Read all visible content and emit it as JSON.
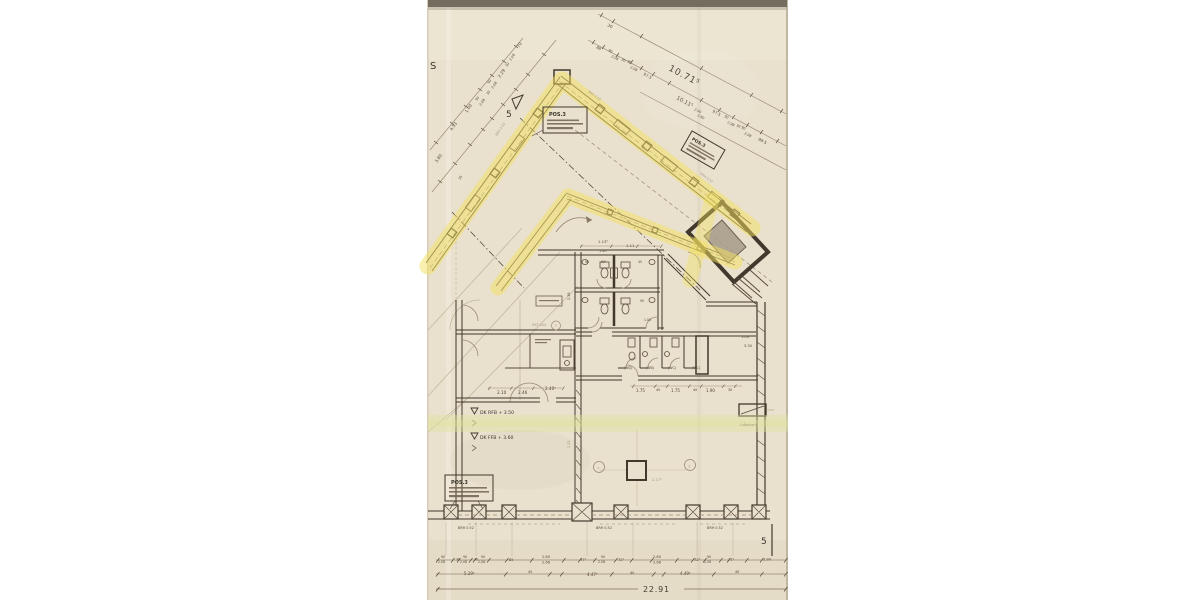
{
  "meta": {
    "description": "Scanned architectural ground-floor plan with yellow highlighter over exterior walls",
    "sheet_type": "floor-plan-scan"
  },
  "palette": {
    "paper": "#e9e1ce",
    "ink": "#5a4c3e",
    "ink_dark": "#42382c",
    "ink_light": "#9a8a72",
    "pencil": "#b9ad95",
    "highlight_yellow": "#f3e25e",
    "highlight_green": "#dfe39b",
    "scan_bar": "#746c5f",
    "vestibule_gray": "#a79b88"
  },
  "landmarks": {
    "sheet_letter": "S",
    "section_marker_top": "5",
    "section_marker_bottom": "5",
    "overall_top": "10.71⁵",
    "overall_top_inner": "10.11⁵",
    "total_width_bottom": "22.91"
  },
  "pos_boxes": [
    {
      "title": "POS.3"
    },
    {
      "title": "POS.3"
    },
    {
      "title": "POS.3"
    }
  ],
  "annotations": [
    {
      "t": "3.80",
      "x": 437,
      "y": 163,
      "r": -56,
      "s": 4.2
    },
    {
      "t": "4.53",
      "x": 452,
      "y": 131,
      "r": -56,
      "s": 4.2
    },
    {
      "t": "1.00",
      "x": 467,
      "y": 113,
      "r": -56,
      "s": 4.2
    },
    {
      "t": "90",
      "x": 477,
      "y": 101,
      "r": -56,
      "s": 3.4
    },
    {
      "t": "2.08",
      "x": 481,
      "y": 106,
      "r": -56,
      "s": 3.4
    },
    {
      "t": "30",
      "x": 488,
      "y": 95,
      "r": -56,
      "s": 3.4
    },
    {
      "t": "90",
      "x": 489,
      "y": 84,
      "r": -56,
      "s": 3.4
    },
    {
      "t": "2.08",
      "x": 493,
      "y": 89,
      "r": -56,
      "s": 3.4
    },
    {
      "t": "2.29",
      "x": 500,
      "y": 78,
      "r": -56,
      "s": 4.2
    },
    {
      "t": "30",
      "x": 507,
      "y": 67,
      "r": -56,
      "s": 3.4
    },
    {
      "t": "2.08",
      "x": 511,
      "y": 61,
      "r": -56,
      "s": 3.4
    },
    {
      "t": "70",
      "x": 519,
      "y": 48,
      "r": -56,
      "s": 4.2
    },
    {
      "t": "35",
      "x": 460,
      "y": 180,
      "r": -56,
      "s": 3.4
    },
    {
      "t": "BRH 2.52",
      "x": 497,
      "y": 136,
      "r": -56,
      "s": 3.2,
      "c": "faint"
    },
    {
      "t": "BRH 2.52",
      "x": 588,
      "y": 92,
      "r": 37,
      "s": 3.2,
      "c": "faint"
    },
    {
      "t": "BRH 2.52",
      "x": 700,
      "y": 174,
      "r": 37,
      "s": 3.2,
      "c": "faint"
    },
    {
      "t": "30",
      "x": 607,
      "y": 26,
      "r": 28,
      "s": 4.2
    },
    {
      "t": "88",
      "x": 596,
      "y": 48,
      "r": 28,
      "s": 3.8
    },
    {
      "t": "90",
      "x": 608,
      "y": 51,
      "r": 28,
      "s": 3.4
    },
    {
      "t": "2.08",
      "x": 611,
      "y": 57,
      "r": 28,
      "s": 3.4
    },
    {
      "t": "30",
      "x": 621,
      "y": 60,
      "r": 28,
      "s": 3.4
    },
    {
      "t": "90",
      "x": 627,
      "y": 62,
      "r": 28,
      "s": 3.4
    },
    {
      "t": "2.08",
      "x": 630,
      "y": 68,
      "r": 28,
      "s": 3.4
    },
    {
      "t": "97.5",
      "x": 643,
      "y": 75,
      "r": 28,
      "s": 4
    },
    {
      "t": "10.11⁵",
      "x": 676,
      "y": 99,
      "r": 28,
      "s": 5.5
    },
    {
      "t": "2.90",
      "x": 694,
      "y": 110,
      "r": 28,
      "s": 3.4
    },
    {
      "t": "3.80",
      "x": 697,
      "y": 116,
      "r": 28,
      "s": 3.4
    },
    {
      "t": "97.5",
      "x": 712,
      "y": 112,
      "r": 28,
      "s": 4
    },
    {
      "t": "90",
      "x": 724,
      "y": 117,
      "r": 28,
      "s": 3.4
    },
    {
      "t": "2.08",
      "x": 727,
      "y": 123,
      "r": 28,
      "s": 3.4
    },
    {
      "t": "30",
      "x": 736,
      "y": 126,
      "r": 28,
      "s": 3.4
    },
    {
      "t": "90",
      "x": 741,
      "y": 128,
      "r": 28,
      "s": 3.4
    },
    {
      "t": "2.08",
      "x": 744,
      "y": 134,
      "r": 28,
      "s": 3.4
    },
    {
      "t": "88.5",
      "x": 758,
      "y": 140,
      "r": 28,
      "s": 4
    },
    {
      "t": "1.13⁵",
      "x": 598,
      "y": 243,
      "s": 3.8
    },
    {
      "t": "1.11",
      "x": 626,
      "y": 247,
      "s": 3.8
    },
    {
      "t": "1.40",
      "x": 599,
      "y": 252,
      "s": 3.4
    },
    {
      "t": "90",
      "x": 585,
      "y": 263,
      "s": 3.2
    },
    {
      "t": "62⁵",
      "x": 601,
      "y": 263,
      "s": 3.2
    },
    {
      "t": "45",
      "x": 638,
      "y": 263,
      "s": 3.2
    },
    {
      "t": "90",
      "x": 640,
      "y": 302,
      "s": 3.2
    },
    {
      "t": "2.38",
      "x": 570,
      "y": 300,
      "r": -90,
      "s": 3.4
    },
    {
      "t": "1.00",
      "x": 644,
      "y": 321,
      "s": 3.2
    },
    {
      "t": "2.10",
      "x": 497,
      "y": 394,
      "s": 4.2
    },
    {
      "t": "2.46",
      "x": 518,
      "y": 394,
      "s": 4.2
    },
    {
      "t": "2.40⁵",
      "x": 545,
      "y": 390,
      "s": 4.2
    },
    {
      "t": "HST 204",
      "x": 532,
      "y": 326,
      "s": 3.3,
      "c": "faint"
    },
    {
      "t": "7",
      "x": 554.5,
      "y": 327,
      "s": 3.6,
      "c": "faint",
      "n": "circled-number"
    },
    {
      "t": "DK RFB + 3.50",
      "x": 480,
      "y": 414,
      "s": 4.6,
      "c": "dark",
      "n": "level-label"
    },
    {
      "t": "DK FFB + 3.60",
      "x": 480,
      "y": 439,
      "s": 4.6,
      "c": "dark",
      "n": "level-label"
    },
    {
      "t": "(WD)",
      "x": 624,
      "y": 369,
      "s": 3.3
    },
    {
      "t": "(WB)",
      "x": 646,
      "y": 369,
      "s": 3.3
    },
    {
      "t": "(WC)",
      "x": 668,
      "y": 369,
      "s": 3.3
    },
    {
      "t": "(WC)",
      "x": 692,
      "y": 369,
      "s": 3.3
    },
    {
      "t": "1.75",
      "x": 636,
      "y": 392,
      "s": 4
    },
    {
      "t": "40",
      "x": 656,
      "y": 391,
      "s": 3.4
    },
    {
      "t": "1.75",
      "x": 671,
      "y": 392,
      "s": 4
    },
    {
      "t": "40",
      "x": 693,
      "y": 391,
      "s": 3.4
    },
    {
      "t": "1.90",
      "x": 706,
      "y": 392,
      "s": 4
    },
    {
      "t": "30",
      "x": 728,
      "y": 391,
      "s": 3.4
    },
    {
      "t": "1.04",
      "x": 741,
      "y": 338,
      "s": 3.6
    },
    {
      "t": "3.30",
      "x": 744,
      "y": 347,
      "s": 3.6
    },
    {
      "t": "Luftschacht",
      "x": 740,
      "y": 426,
      "s": 3.1,
      "c": "faint",
      "n": "shaft-label"
    },
    {
      "t": "2",
      "x": 688.3,
      "y": 467.5,
      "s": 3.6,
      "c": "faint",
      "n": "circled-number"
    },
    {
      "t": "7",
      "x": 597.3,
      "y": 469.5,
      "s": 3.6,
      "c": "faint",
      "n": "circled-number"
    },
    {
      "t": "2.17⁵",
      "x": 652,
      "y": 481,
      "s": 3.8,
      "c": "faint"
    },
    {
      "t": "2.25",
      "x": 570,
      "y": 448,
      "r": -90,
      "s": 3.4,
      "c": "faint"
    },
    {
      "t": "BRH 0.52",
      "x": 458,
      "y": 529,
      "s": 3.4
    },
    {
      "t": "BRH 0.52",
      "x": 596,
      "y": 529,
      "s": 3.4
    },
    {
      "t": "BRH 0.52",
      "x": 707,
      "y": 529,
      "s": 3.4
    },
    {
      "t": "90",
      "x": 441,
      "y": 558,
      "s": 3.2
    },
    {
      "t": "2.08",
      "x": 438,
      "y": 563,
      "s": 3.2
    },
    {
      "t": "30",
      "x": 456,
      "y": 560.5,
      "s": 3.2
    },
    {
      "t": "90",
      "x": 463,
      "y": 558,
      "s": 3.2
    },
    {
      "t": "2.08",
      "x": 460,
      "y": 563,
      "s": 3.2
    },
    {
      "t": "30",
      "x": 474,
      "y": 560.5,
      "s": 3.2
    },
    {
      "t": "90",
      "x": 481,
      "y": 558,
      "s": 3.2
    },
    {
      "t": "2.08",
      "x": 478,
      "y": 563,
      "s": 3.2
    },
    {
      "t": "85",
      "x": 509,
      "y": 561,
      "s": 3.6
    },
    {
      "t": "2.80",
      "x": 542,
      "y": 558,
      "s": 3.6
    },
    {
      "t": "2.66",
      "x": 542,
      "y": 563.5,
      "s": 3.6
    },
    {
      "t": "77⁵",
      "x": 580,
      "y": 561,
      "s": 3.6
    },
    {
      "t": "90",
      "x": 601,
      "y": 558,
      "s": 3.2
    },
    {
      "t": "2.58",
      "x": 598,
      "y": 563,
      "s": 3.2
    },
    {
      "t": "72⁵",
      "x": 618,
      "y": 561,
      "s": 3.6
    },
    {
      "t": "2.80",
      "x": 653,
      "y": 558,
      "s": 3.6
    },
    {
      "t": "2.66",
      "x": 653,
      "y": 563.5,
      "s": 3.6
    },
    {
      "t": "72⁵",
      "x": 694,
      "y": 561,
      "s": 3.6
    },
    {
      "t": "90",
      "x": 707,
      "y": 558,
      "s": 3.2
    },
    {
      "t": "2.58",
      "x": 704,
      "y": 563,
      "s": 3.2
    },
    {
      "t": "77⁵",
      "x": 728,
      "y": 561,
      "s": 3.6
    },
    {
      "t": "2.90",
      "x": 763,
      "y": 560.5,
      "s": 3.6
    },
    {
      "t": "5.29⁵",
      "x": 464,
      "y": 575,
      "s": 4
    },
    {
      "t": "40",
      "x": 528,
      "y": 573,
      "s": 3.4
    },
    {
      "t": "4.47⁵",
      "x": 587,
      "y": 576,
      "s": 4
    },
    {
      "t": "40",
      "x": 630,
      "y": 574,
      "s": 3.4
    },
    {
      "t": "4.49⁵",
      "x": 680,
      "y": 575,
      "s": 4
    },
    {
      "t": "40",
      "x": 735,
      "y": 573,
      "s": 3.4
    }
  ]
}
